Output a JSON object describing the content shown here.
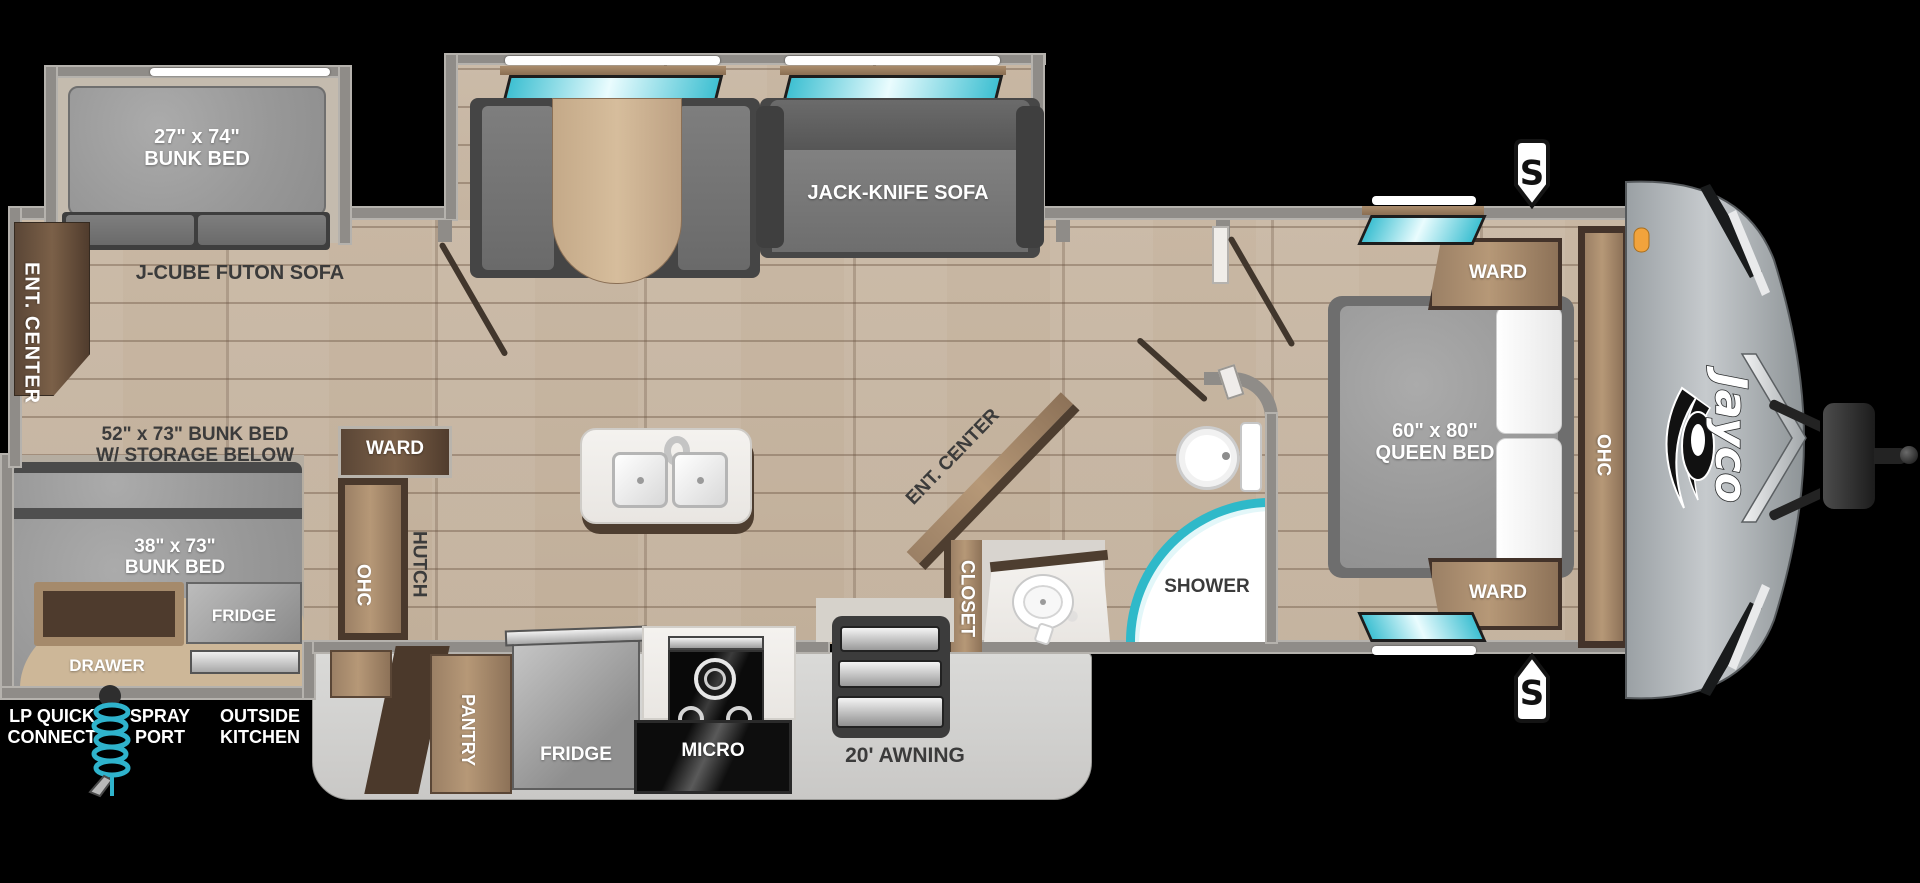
{
  "brand": {
    "logo": "Jayco"
  },
  "exterior": {
    "awning": "20' AWNING",
    "lp_quick_connect": "LP QUICK\nCONNECT",
    "spray_port": "SPRAY\nPORT",
    "outside_kitchen": "OUTSIDE\nKITCHEN",
    "speaker_top": "S",
    "speaker_bottom": "S"
  },
  "bunkhouse": {
    "bunk27": "27\" x 74\"\nBUNK BED",
    "futon_sofa": "J-CUBE FUTON SOFA",
    "ent_center": "ENT. CENTER",
    "bunk52": "52\" x 73\" BUNK BED\nW/ STORAGE BELOW",
    "bunk38": "38\" x 73\"\nBUNK BED",
    "fridge": "FRIDGE",
    "drawer": "DRAWER",
    "ward": "WARD",
    "ohc": "OHC",
    "hutch": "HUTCH"
  },
  "living": {
    "jack_knife_sofa": "JACK-KNIFE SOFA"
  },
  "kitchen": {
    "pantry": "PANTRY",
    "fridge": "FRIDGE",
    "micro": "MICRO"
  },
  "bath": {
    "ent_center": "ENT. CENTER",
    "closet": "CLOSET",
    "shower": "SHOWER"
  },
  "bedroom": {
    "queen": "60\" x 80\"\nQUEEN BED",
    "ward_top": "WARD",
    "ward_bottom": "WARD",
    "ohc": "OHC"
  },
  "colors": {
    "floor_wood": "#c5b39e",
    "wall_gray": "#8f8c88",
    "window_teal": "#3fc0d2",
    "awning_gray": "#d3d2d0",
    "cabinet_wood": "#a98c6c",
    "mattress_gray": "#9a9a9a",
    "outside_tan": "#cdb798",
    "marker_orange": "#f2a33c"
  }
}
